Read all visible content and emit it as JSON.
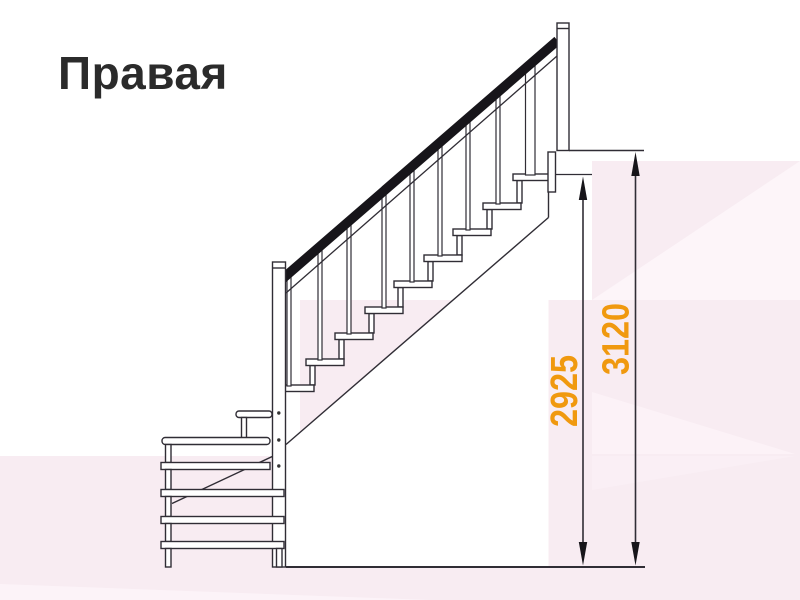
{
  "title": "Правая",
  "dimensions": {
    "inner_height": "2925",
    "total_height": "3120"
  },
  "colors": {
    "dimension_text": "#F0990F",
    "line_art": "#302D35",
    "handrail": "#17151A",
    "title_text": "#2B2B2B",
    "background": "#FFFFFF",
    "background_pink": "#F8ECF2",
    "background_pink_light": "#FDF5F9"
  }
}
